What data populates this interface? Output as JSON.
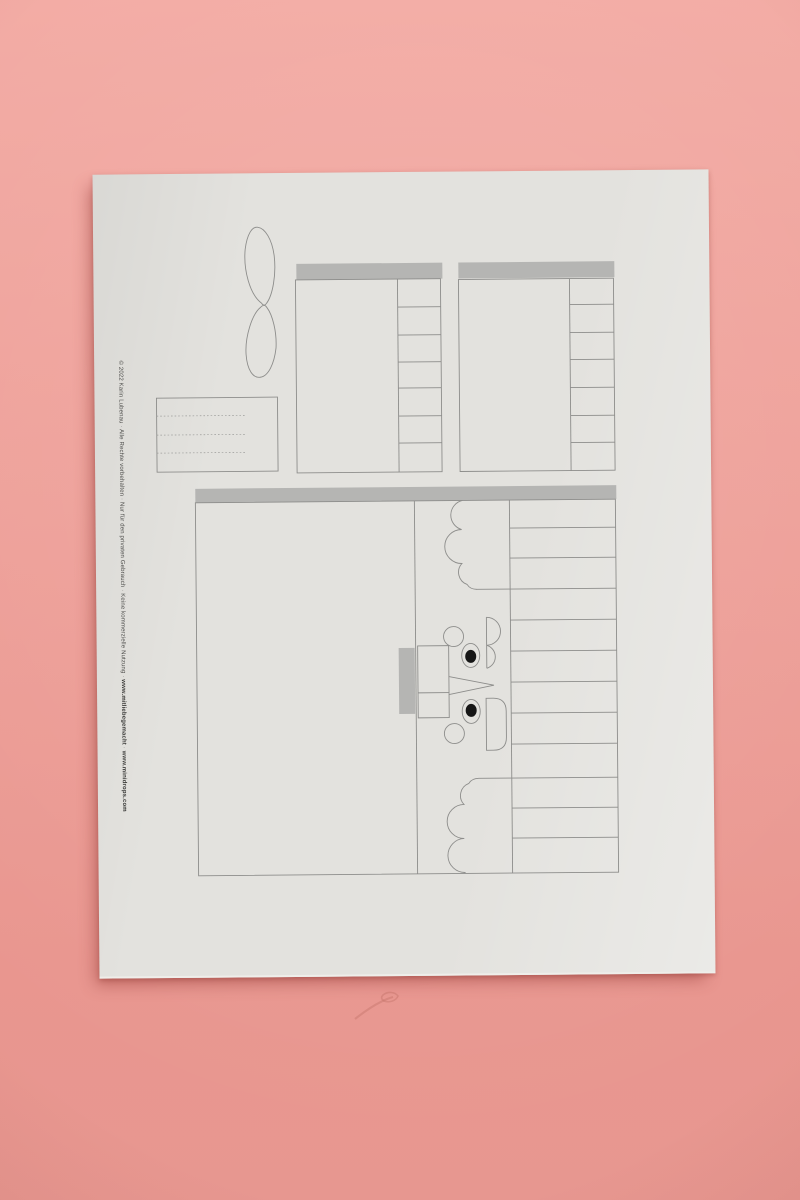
{
  "photo": {
    "description": "Photograph of a printed papercraft nutcracker cut-out template sheet lying on a pink paper background",
    "background_color": "#ee9d96",
    "paper_color": "#e3e2de",
    "outline_color": "#8d8d8b",
    "bar_color": "#b5b5b3",
    "pupil_color": "#161616"
  },
  "credit": {
    "copyright": "© 2022 Karin Lubenau",
    "rights": "Alle Rechte vorbehalten",
    "private_use": "Nur für den privaten Gebrauch",
    "no_commercial": "Keine kommerzielle Nutzung",
    "url_1": "www.mitliebegemacht",
    "url_2": "www.minidrops.com",
    "separator": " · "
  },
  "pieces": {
    "bow": "bow / wing shape",
    "label_card": "small card with three dotted fold lines",
    "side_panel_a": "small box wrap with gray glue bar and 7 fold tabs",
    "side_panel_b": "small box wrap with gray glue bar and 7 fold tabs",
    "body_wrap": "large nutcracker body wrap with gray glue bar, curly hair scallops, face with eyes, nose fold and tab ladder"
  }
}
